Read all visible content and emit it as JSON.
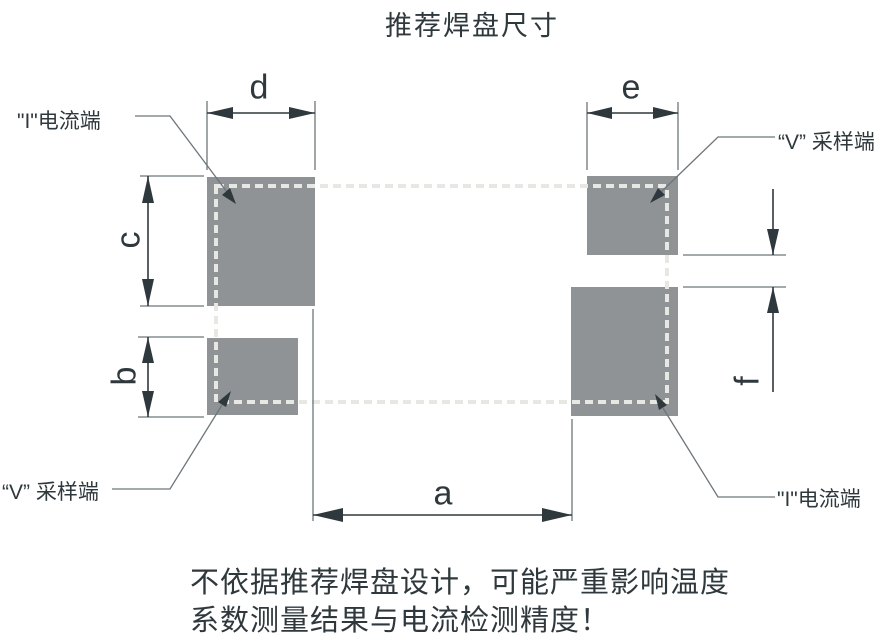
{
  "title": "推荐焊盘尺寸",
  "colors": {
    "bg": "#ffffff",
    "pad": "#8f9396",
    "ink": "#2f383c",
    "thin": "#6e767a",
    "dash": "#e7e7e3"
  },
  "terminals": {
    "top_left": "\"I\"电流端",
    "top_right": "“V” 采样端",
    "bottom_left": "“V” 采样端",
    "bottom_right": "\"I\"电流端"
  },
  "dim_labels": {
    "a": "a",
    "b": "b",
    "c": "c",
    "d": "d",
    "e": "e",
    "f": "f"
  },
  "warning": {
    "line1": "不依据推荐焊盘设计，可能严重影响温度",
    "line2": "系数测量结果与电流检测精度！"
  }
}
